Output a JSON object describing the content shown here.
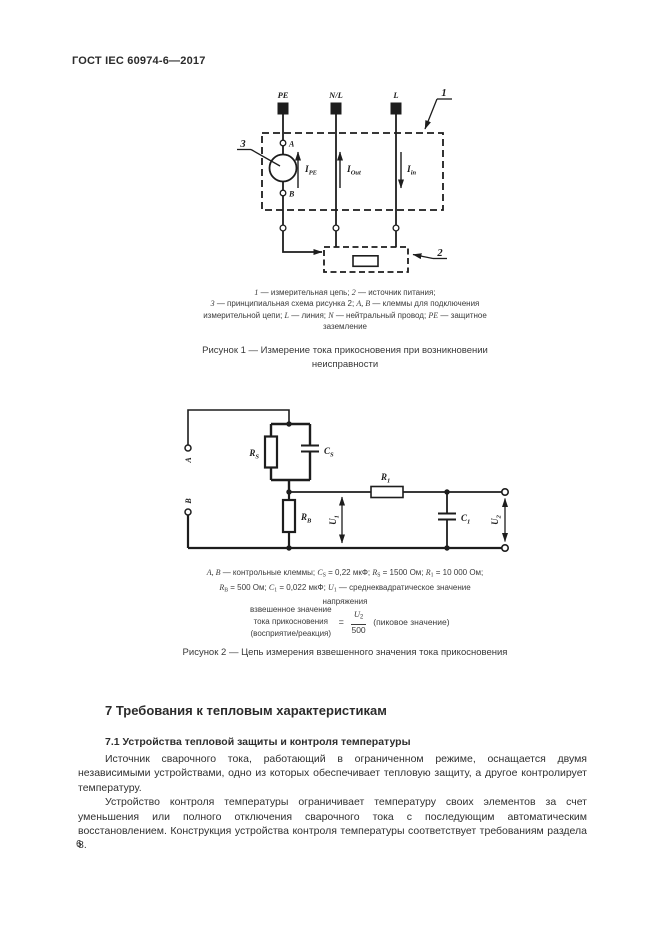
{
  "page": {
    "header": "ГОСТ IEC 60974-6—2017",
    "number": "6"
  },
  "figure1": {
    "terminal_pe": "PE",
    "terminal_nl": "N/L",
    "terminal_l": "L",
    "callout_1": "1",
    "callout_2": "2",
    "callout_3": "3",
    "point_a": "A",
    "point_b": "B",
    "ipe_main": "I",
    "ipe_sub": "PE",
    "iout_main": "I",
    "iout_sub": "Out",
    "iin_main": "I",
    "iin_sub": "in",
    "legend_lines": [
      [
        {
          "i": "1"
        },
        " — измерительная цепь; ",
        {
          "i": "2"
        },
        " — источник питания;"
      ],
      [
        {
          "i": "3"
        },
        " — принципиальная схема рисунка 2; ",
        {
          "i": "A, B"
        },
        " — клеммы для подключения"
      ],
      [
        "измерительной цепи; ",
        {
          "i": "L"
        },
        " — линия; ",
        {
          "i": "N"
        },
        " — нейтральный провод; ",
        {
          "i": "PE"
        },
        " — защитное"
      ],
      [
        "заземление"
      ]
    ],
    "caption_lines": [
      "Рисунок 1 — Измерение тока прикосновения при возникновении",
      "неисправности"
    ]
  },
  "figure2": {
    "label_a": "A",
    "label_b": "B",
    "rs_main": "R",
    "rs_sub": "S",
    "cs_main": "C",
    "cs_sub": "S",
    "r1_main": "R",
    "r1_sub": "1",
    "rb_main": "R",
    "rb_sub": "B",
    "c1_main": "C",
    "c1_sub": "1",
    "u1_main": "U",
    "u1_sub": "1",
    "u2_main": "U",
    "u2_sub": "2",
    "legend_lines": [
      [
        {
          "i": "A, B"
        },
        " — контрольные клеммы; ",
        {
          "i": "C"
        },
        {
          "sub": "S"
        },
        " = 0,22 мкФ; ",
        {
          "i": "R"
        },
        {
          "sub": "S"
        },
        " = 1500 Ом; ",
        {
          "i": "R"
        },
        {
          "sub": "1"
        },
        " = 10 000 Ом;"
      ],
      [
        {
          "i": "R"
        },
        {
          "sub": "B"
        },
        " = 500 Ом; ",
        {
          "i": "C"
        },
        {
          "sub": "1"
        },
        " = 0,022 мкФ; ",
        {
          "i": "U"
        },
        {
          "sub": "1"
        },
        " — среднеквадратическое значение"
      ],
      [
        "напряжения"
      ]
    ],
    "formula": {
      "left_lines": [
        "взвешенное значение",
        "тока прикосновения",
        "(восприятие/реакция)"
      ],
      "equals": "=",
      "num_main": "U",
      "num_sub": "2",
      "den": "500",
      "right": "(пиковое значение)"
    },
    "caption": "Рисунок 2 — Цепь измерения взвешенного значения тока прикосновения"
  },
  "section": {
    "h1": "7 Требования к тепловым характеристикам",
    "h2": "7.1 Устройства тепловой защиты и контроля температуры",
    "para1": "Источник сварочного тока, работающий в ограниченном режиме, оснащается двумя независимыми устройствами, одно из которых обеспечивает тепловую защиту, а другое контролирует температуру.",
    "para2": "Устройство контроля температуры ограничивает температуру своих элементов за счет уменьшения или полного отключения сварочного тока с последующим автоматическим восстановлением. Конструкция устройства контроля температуры соответствует требованиям раздела 8."
  }
}
